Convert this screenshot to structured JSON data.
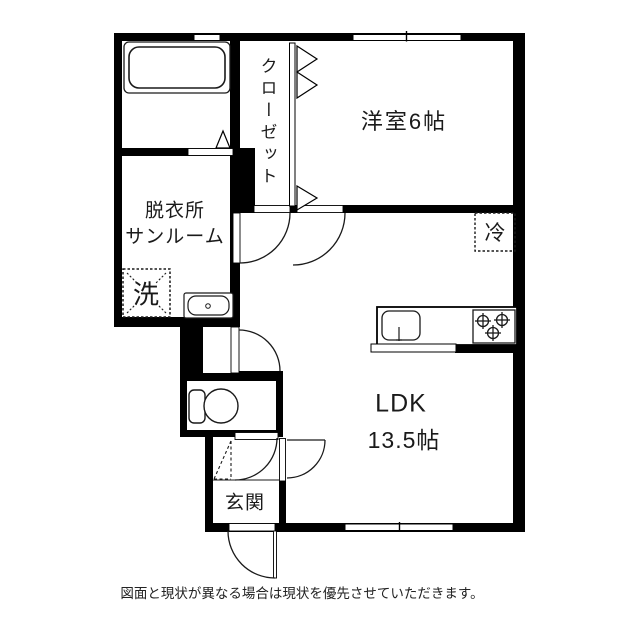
{
  "plan": {
    "rooms": {
      "dressing_room": {
        "label_line1": "脱衣所",
        "label_line2": "サンルーム"
      },
      "closet": {
        "label": "クローゼット"
      },
      "western_room": {
        "label": "洋室6帖"
      },
      "ldk": {
        "label_line1": "LDK",
        "label_line2": "13.5帖"
      },
      "genkan": {
        "label": "玄関"
      }
    },
    "appliances": {
      "washer_label": "洗",
      "fridge_label": "冷"
    },
    "icons": [
      "bathtub-icon",
      "washbasin-icon",
      "toilet-icon",
      "kitchen-sink-icon",
      "stove-icon"
    ],
    "note": "図面と現状が異なる場合は現状を優先させていただきます。",
    "colors": {
      "wall": "#000000",
      "line": "#1a1a1a",
      "background": "#ffffff"
    }
  }
}
